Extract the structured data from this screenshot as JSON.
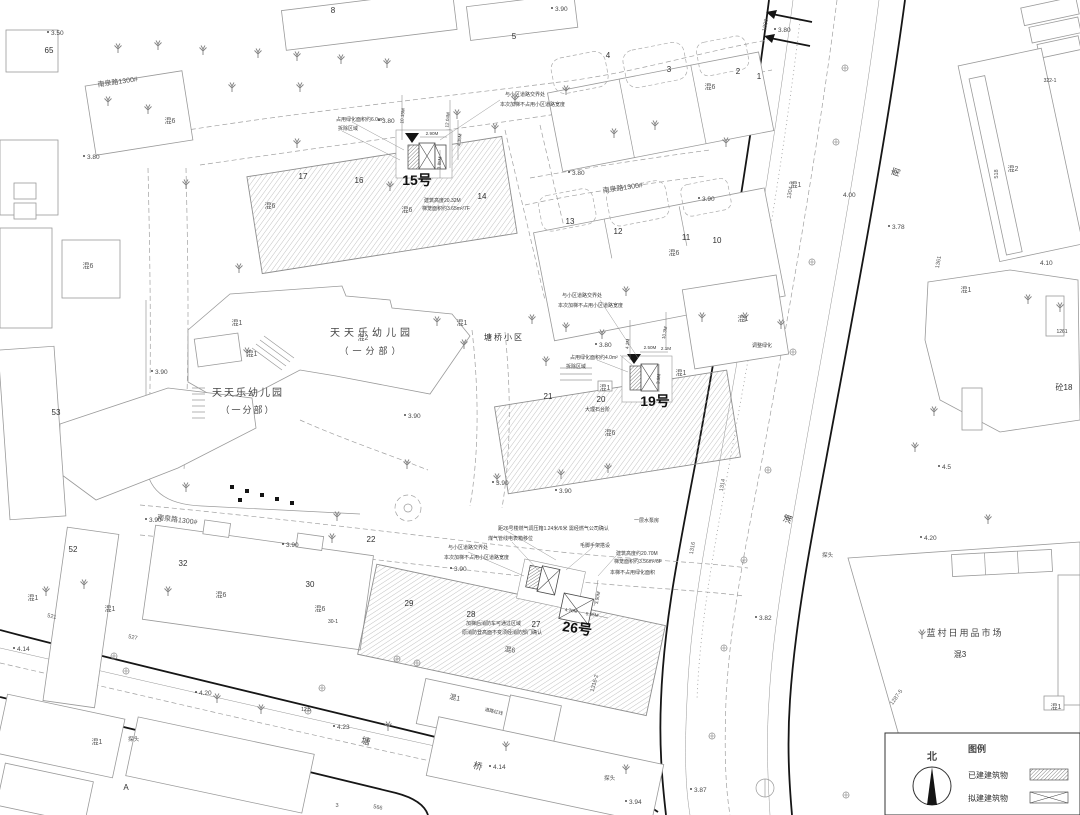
{
  "legend": {
    "title": "图例",
    "north": "北",
    "existing": "已建建筑物",
    "proposed": "拟建建筑物"
  },
  "sites": {
    "kg": "天天乐幼儿园",
    "kg_branch": "（一分部）",
    "estate": "塘桥小区",
    "market": "蓝村日用品市场"
  },
  "roads": {
    "nanquan": "南泉路1300#",
    "tang": "塘",
    "qiao": "桥",
    "nan": "南",
    "pu": "浦"
  },
  "majors": {
    "b15": "15号",
    "b19": "19号",
    "b26": "26号"
  },
  "types": {
    "h1": "混1",
    "h2": "混2",
    "h3": "混3",
    "h6": "混6",
    "t18": "砼18"
  },
  "units": {
    "u1": "1",
    "u2": "2",
    "u3": "3",
    "u4": "4",
    "u5": "5",
    "u8": "8",
    "u10": "10",
    "u11": "11",
    "u12": "12",
    "u13": "13",
    "u14": "14",
    "u16": "16",
    "u17": "17",
    "u20": "20",
    "u21": "21",
    "u22": "22",
    "u27": "27",
    "u28": "28",
    "u29": "29",
    "u30": "30",
    "u32": "32",
    "u52": "52",
    "u53": "53",
    "u65": "65",
    "uA": "A"
  },
  "stakes": {
    "s1300": "1300",
    "s1304": "1304-3",
    "s1361": "1361",
    "s1314": "1314",
    "s1316": "1316",
    "s1316_2": "1316-2",
    "s1287": "1287-5",
    "s1261": "1261",
    "s322": "322-1",
    "s518": "518",
    "s521": "521",
    "s527": "527",
    "s566": "566",
    "s125": "12.5",
    "s301": "30-1",
    "s3": "3"
  },
  "elev": {
    "v350": "3.50",
    "v378": "3.78",
    "v380": "3.80",
    "v382": "3.82",
    "v387": "3.87",
    "v390": "3.90",
    "v394": "3.94",
    "v400": "4.00",
    "v410": "4.10",
    "v414": "4.14",
    "v420": "4.20",
    "v423": "4.23",
    "v45": "4.5"
  },
  "ann15": {
    "green": "占用绿化面积约6.0m²",
    "demolish": "拆除区域",
    "road1": "与小区道路交界处",
    "road2": "本次加梯不占用小区道路宽度",
    "height": "建筑高度20.32M",
    "cage": "梯笼面积约3.65m²/7F",
    "m1": "2.90M",
    "m2": "12.04M",
    "m3": "4.35M",
    "m4": "3.85M",
    "m5": "10.15M"
  },
  "ann19": {
    "green": "占用绿化面积约4.0m²",
    "demolish": "拆除区域",
    "road1": "与小区道路交界处",
    "road2": "本次加梯不占用小区道路宽度",
    "steps": "大理石台阶",
    "adjust": "调整绿化",
    "m1": "2.50M",
    "m2": "2.1M",
    "m3": "4.2M",
    "m4": "10.3M",
    "m5": "3.9M"
  },
  "ann26": {
    "gas": "距26号楼燃气调压箱1.24米/6米 需经燃气公司确认",
    "pump": "一层水泵房",
    "meter": "煤气管线电表箱移位",
    "scaffold": "毛脚手架搭设",
    "height": "建筑高度约20.70M",
    "cage": "梯笼面积约3.56m²/6F",
    "nogreen": "本梯不占用绿化面积",
    "road1": "与小区道路交界处",
    "road2": "本次加梯不占用小区道路宽度",
    "fire1": "加梯后消防车可通过区域",
    "fire2": "原消防登高面不变须经消防部门确认",
    "m1": "4.70M",
    "m2": "5.05M",
    "m3": "3.90M"
  },
  "misc": {
    "camera": "探头",
    "redline": "道路红线"
  }
}
